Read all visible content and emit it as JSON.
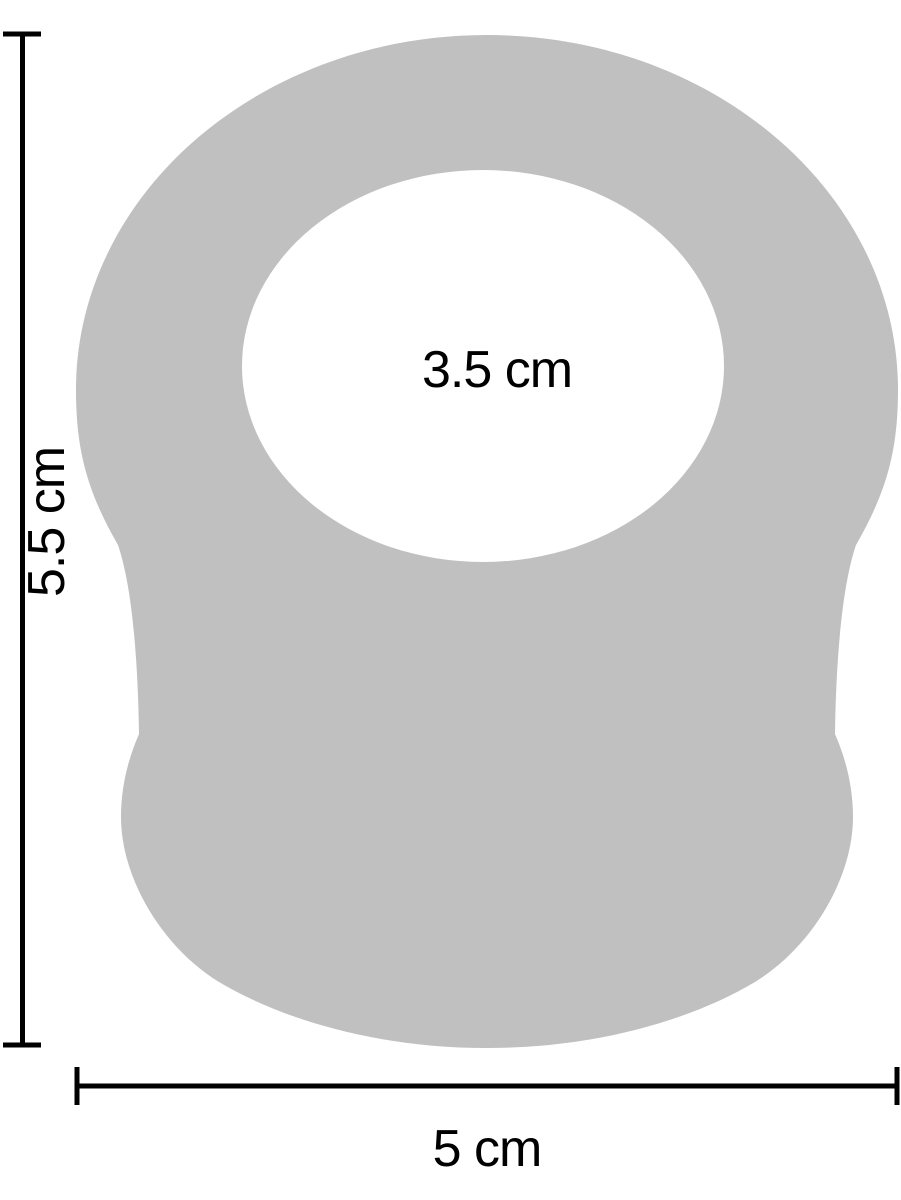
{
  "figure": {
    "labels": {
      "inner_diameter": "3.5 cm",
      "height": "5.5 cm",
      "width": "5 cm"
    }
  },
  "colors": {
    "silhouette": "#c0c0c0",
    "lines": "#000000",
    "text": "#000000",
    "background": "#ffffff"
  }
}
